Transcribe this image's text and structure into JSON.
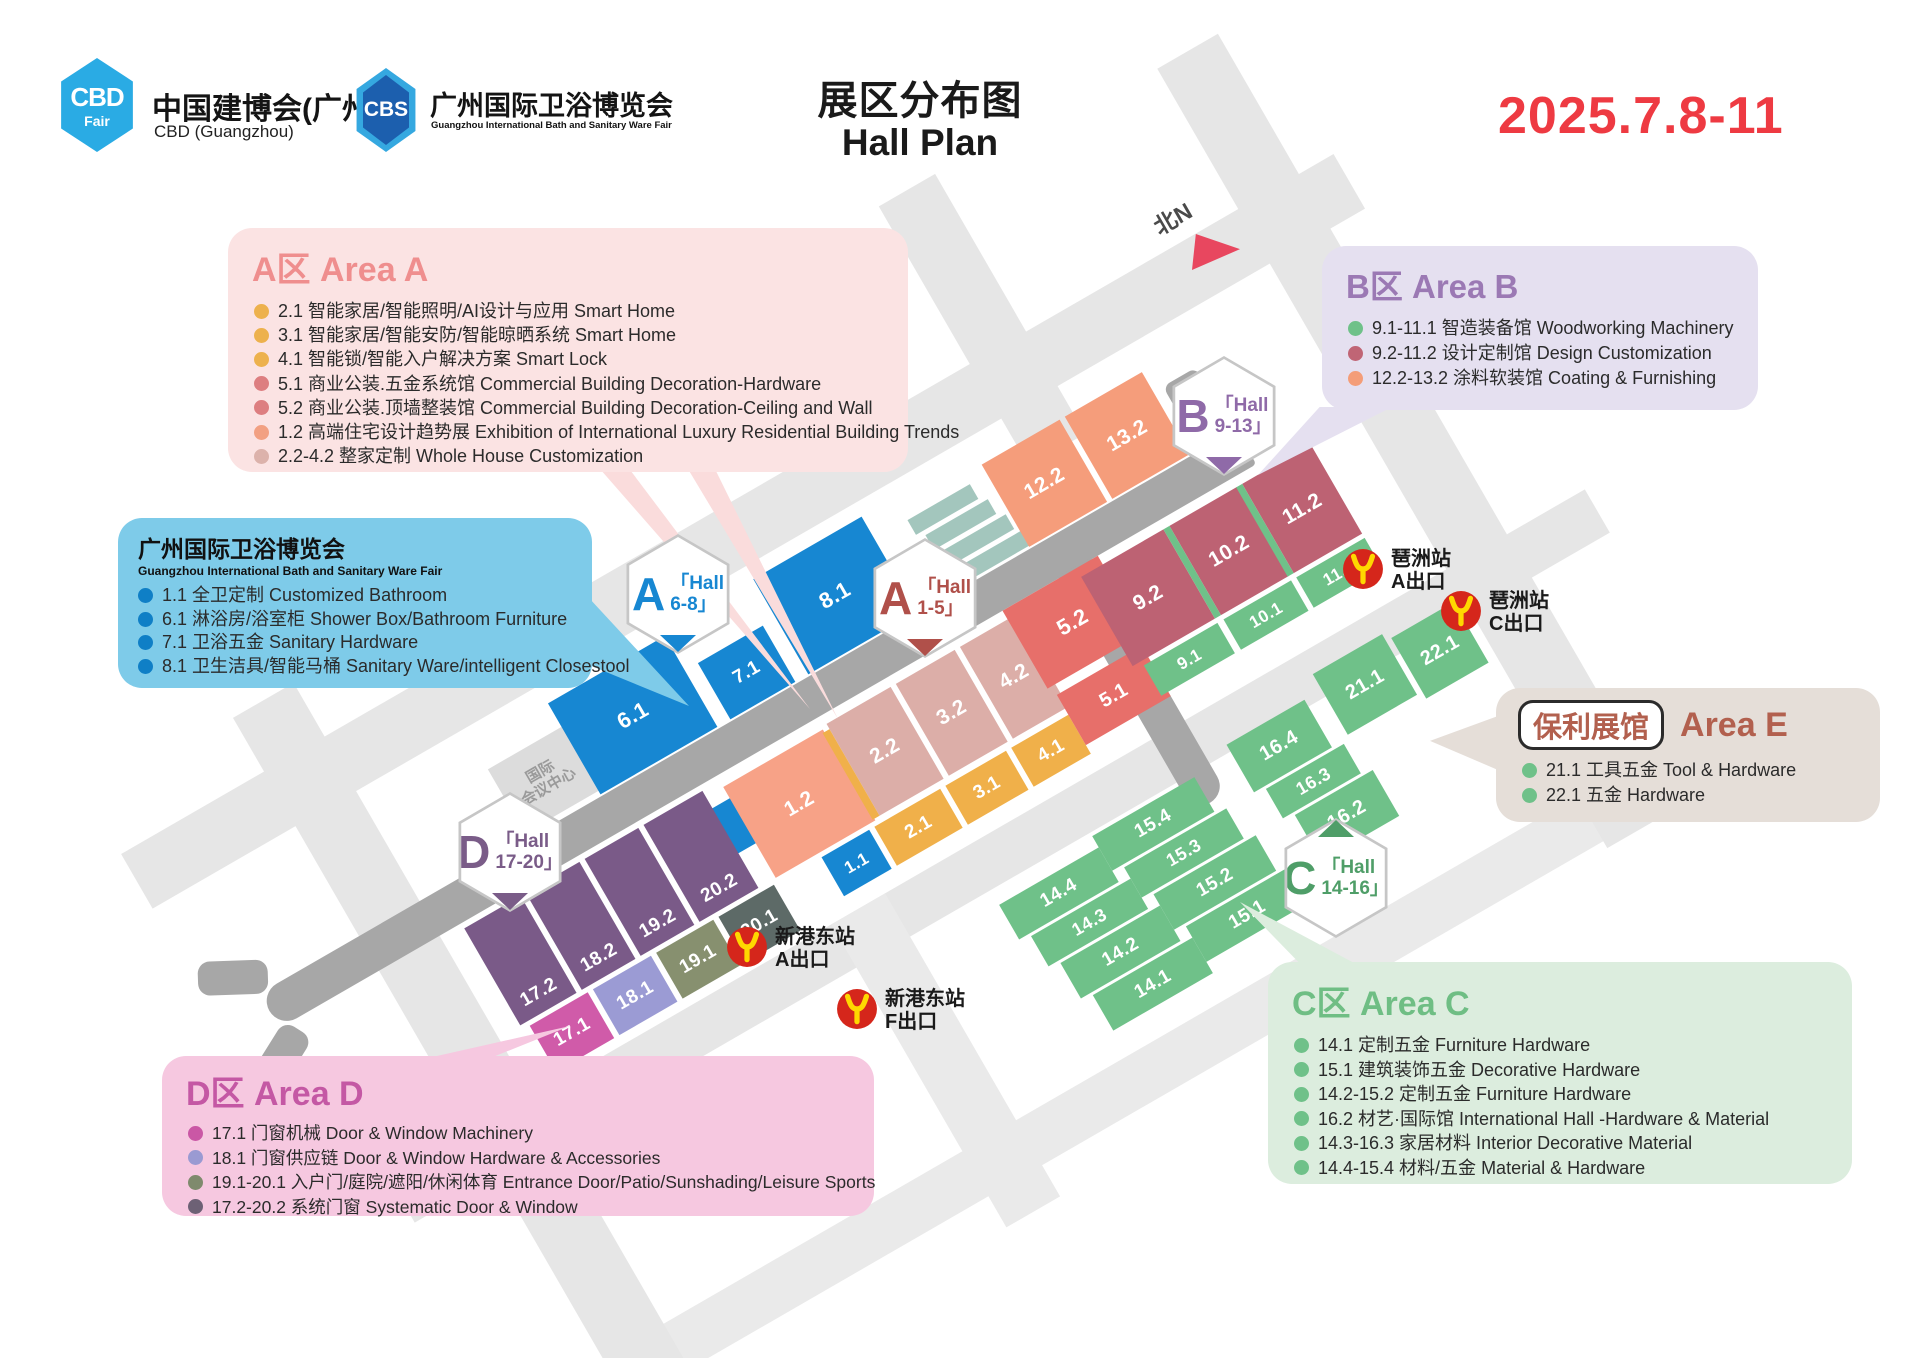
{
  "header": {
    "logo_cbd": {
      "badge_line1": "CBD",
      "badge_line2": "Fair",
      "title": "中国建博会(广州)",
      "subtitle": "CBD (Guangzhou)"
    },
    "logo_cbs": {
      "badge": "CBS",
      "title": "广州国际卫浴博览会",
      "subtitle": "Guangzhou International Bath and Sanitary Ware Fair"
    },
    "title_cn": "展区分布图",
    "title_en": "Hall Plan",
    "date": "2025.7.8-11"
  },
  "legends": {
    "area_a": {
      "title": "A区 Area A",
      "accent": "#ef8e8e",
      "items": [
        {
          "dot": "#edb14d",
          "text": "2.1 智能家居/智能照明/AI设计与应用 Smart Home"
        },
        {
          "dot": "#edb14d",
          "text": "3.1 智能家居/智能安防/智能晾晒系统 Smart Home"
        },
        {
          "dot": "#edb14d",
          "text": "4.1 智能锁/智能入户解决方案 Smart Lock"
        },
        {
          "dot": "#dd7e80",
          "text": "5.1 商业公装.五金系统馆 Commercial Building Decoration-Hardware"
        },
        {
          "dot": "#dd7e80",
          "text": "5.2 商业公装.顶墙整装馆 Commercial Building Decoration-Ceiling and Wall"
        },
        {
          "dot": "#f2a082",
          "text": "1.2 高端住宅设计趋势展 Exhibition of International Luxury Residential Building Trends"
        },
        {
          "dot": "#dcb2ab",
          "text": "2.2-4.2 整家定制 Whole House Customization"
        }
      ]
    },
    "bath": {
      "title": "广州国际卫浴博览会",
      "subtitle": "Guangzhou International Bath and Sanitary Ware Fair",
      "items": [
        {
          "dot": "#0f7fc6",
          "text": "1.1 全卫定制 Customized Bathroom"
        },
        {
          "dot": "#0f7fc6",
          "text": "6.1 淋浴房/浴室柜 Shower Box/Bathroom Furniture"
        },
        {
          "dot": "#0f7fc6",
          "text": "7.1 卫浴五金 Sanitary Hardware"
        },
        {
          "dot": "#0f7fc6",
          "text": "8.1 卫生洁具/智能马桶 Sanitary Ware/intelligent Closestool"
        }
      ]
    },
    "area_b": {
      "title": "B区 Area B",
      "accent": "#9b79b4",
      "items": [
        {
          "dot": "#6fc189",
          "text": "9.1-11.1 智造装备馆 Woodworking Machinery"
        },
        {
          "dot": "#c06575",
          "text": "9.2-11.2 设计定制馆 Design Customization"
        },
        {
          "dot": "#f49d78",
          "text": "12.2-13.2 涂料软装馆 Coating & Furnishing"
        }
      ]
    },
    "area_e": {
      "badge": "保利展馆",
      "title": "Area E",
      "accent": "#b2604e",
      "items": [
        {
          "dot": "#6fc189",
          "text": "21.1 工具五金 Tool & Hardware"
        },
        {
          "dot": "#6fc189",
          "text": "22.1 五金 Hardware"
        }
      ]
    },
    "area_c": {
      "title": "C区 Area C",
      "accent": "#6fbe84",
      "items": [
        {
          "dot": "#6fc189",
          "text": "14.1 定制五金 Furniture Hardware"
        },
        {
          "dot": "#6fc189",
          "text": "15.1 建筑装饰五金 Decorative Hardware"
        },
        {
          "dot": "#6fc189",
          "text": "14.2-15.2 定制五金 Furniture Hardware"
        },
        {
          "dot": "#6fc189",
          "text": "16.2 材艺·国际馆 International Hall -Hardware & Material"
        },
        {
          "dot": "#6fc189",
          "text": "14.3-16.3 家居材料 Interior Decorative Material"
        },
        {
          "dot": "#6fc189",
          "text": "14.4-15.4 材料/五金 Material & Hardware"
        }
      ]
    },
    "area_d": {
      "title": "D区 Area D",
      "accent": "#c458a4",
      "items": [
        {
          "dot": "#ca57a5",
          "text": "17.1 门窗机械  Door & Window Machinery"
        },
        {
          "dot": "#9a9ad2",
          "text": "18.1 门窗供应链  Door & Window Hardware & Accessories"
        },
        {
          "dot": "#7f8a6d",
          "text": "19.1-20.1 入户门/庭院/遮阳/休闲体育 Entrance Door/Patio/Sunshading/Leisure Sports"
        },
        {
          "dot": "#6d6175",
          "text": "17.2-20.2 系统门窗 Systematic Door & Window"
        }
      ]
    }
  },
  "map": {
    "north": {
      "label": "北N"
    },
    "landmark": {
      "line1": "国际",
      "line2": "会议中心"
    },
    "badges": [
      {
        "letter": "A",
        "hall": "「Hall",
        "range": "6-8」",
        "color": "#1787d2"
      },
      {
        "letter": "A",
        "hall": "「Hall",
        "range": "1-5」",
        "color": "#b0504a"
      },
      {
        "letter": "B",
        "hall": "「Hall",
        "range": "9-13」",
        "color": "#8f6aa8"
      },
      {
        "letter": "C",
        "hall": "「Hall",
        "range": "14-16」",
        "color": "#4f9e68"
      },
      {
        "letter": "D",
        "hall": "「Hall",
        "range": "17-20」",
        "color": "#7a5c88"
      }
    ],
    "stations": [
      {
        "name": "琶洲站",
        "exit": "A出口"
      },
      {
        "name": "琶洲站",
        "exit": "C出口"
      },
      {
        "name": "新港东站",
        "exit": "A出口"
      },
      {
        "name": "新港东站",
        "exit": "F出口"
      }
    ],
    "halls": [
      {
        "id": "dec-blue",
        "label": "",
        "color": "#1787d2"
      },
      {
        "id": "h61",
        "label": "6.1",
        "color": "#1787d2"
      },
      {
        "id": "h71",
        "label": "7.1",
        "color": "#1787d2"
      },
      {
        "id": "h81",
        "label": "8.1",
        "color": "#1787d2"
      },
      {
        "id": "h12",
        "label": "1.2",
        "color": "#f7a287"
      },
      {
        "id": "h22",
        "label": "2.2",
        "color": "#dcaea8"
      },
      {
        "id": "h32",
        "label": "3.2",
        "color": "#dcaea8"
      },
      {
        "id": "h42",
        "label": "4.2",
        "color": "#dcaea8"
      },
      {
        "id": "h52",
        "label": "5.2",
        "color": "#e76f6a"
      },
      {
        "id": "h11",
        "label": "1.1",
        "color": "#1787d2"
      },
      {
        "id": "h21",
        "label": "2.1",
        "color": "#f0b04a"
      },
      {
        "id": "h31",
        "label": "3.1",
        "color": "#f0b04a"
      },
      {
        "id": "h41",
        "label": "4.1",
        "color": "#f0b04a"
      },
      {
        "id": "h51",
        "label": "5.1",
        "color": "#e76f6a"
      },
      {
        "id": "h122",
        "label": "12.2",
        "color": "#f59d7b"
      },
      {
        "id": "h132",
        "label": "13.2",
        "color": "#f59d7b"
      },
      {
        "id": "h92",
        "label": "9.2",
        "color": "#bd6273"
      },
      {
        "id": "h102",
        "label": "10.2",
        "color": "#bd6273"
      },
      {
        "id": "h112",
        "label": "11.2",
        "color": "#bd6273"
      },
      {
        "id": "h91",
        "label": "9.1",
        "color": "#6fc189"
      },
      {
        "id": "h101",
        "label": "10.1",
        "color": "#6fc189"
      },
      {
        "id": "h111",
        "label": "11.1",
        "color": "#6fc189"
      },
      {
        "id": "h211",
        "label": "21.1",
        "color": "#6fc189"
      },
      {
        "id": "h221",
        "label": "22.1",
        "color": "#6fc189"
      },
      {
        "id": "h164",
        "label": "16.4",
        "color": "#6fc189"
      },
      {
        "id": "h163",
        "label": "16.3",
        "color": "#6fc189"
      },
      {
        "id": "h162",
        "label": "16.2",
        "color": "#6fc189"
      },
      {
        "id": "h154",
        "label": "15.4",
        "color": "#6fc189"
      },
      {
        "id": "h153",
        "label": "15.3",
        "color": "#6fc189"
      },
      {
        "id": "h152",
        "label": "15.2",
        "color": "#6fc189"
      },
      {
        "id": "h151",
        "label": "15.1",
        "color": "#6fc189"
      },
      {
        "id": "h144",
        "label": "14.4",
        "color": "#6fc189"
      },
      {
        "id": "h143",
        "label": "14.3",
        "color": "#6fc189"
      },
      {
        "id": "h142",
        "label": "14.2",
        "color": "#6fc189"
      },
      {
        "id": "h141",
        "label": "14.1",
        "color": "#6fc189"
      },
      {
        "id": "h172",
        "label": "17.2",
        "color": "#7a5a88"
      },
      {
        "id": "h182",
        "label": "18.2",
        "color": "#7a5a88"
      },
      {
        "id": "h192",
        "label": "19.2",
        "color": "#7a5a88"
      },
      {
        "id": "h202",
        "label": "20.2",
        "color": "#7a5a88"
      },
      {
        "id": "h171",
        "label": "17.1",
        "color": "#d05ba9"
      },
      {
        "id": "h181",
        "label": "18.1",
        "color": "#9b9bd4"
      },
      {
        "id": "h191",
        "label": "19.1",
        "color": "#87906f"
      },
      {
        "id": "h201",
        "label": "20.1",
        "color": "#5d6a67"
      }
    ]
  }
}
